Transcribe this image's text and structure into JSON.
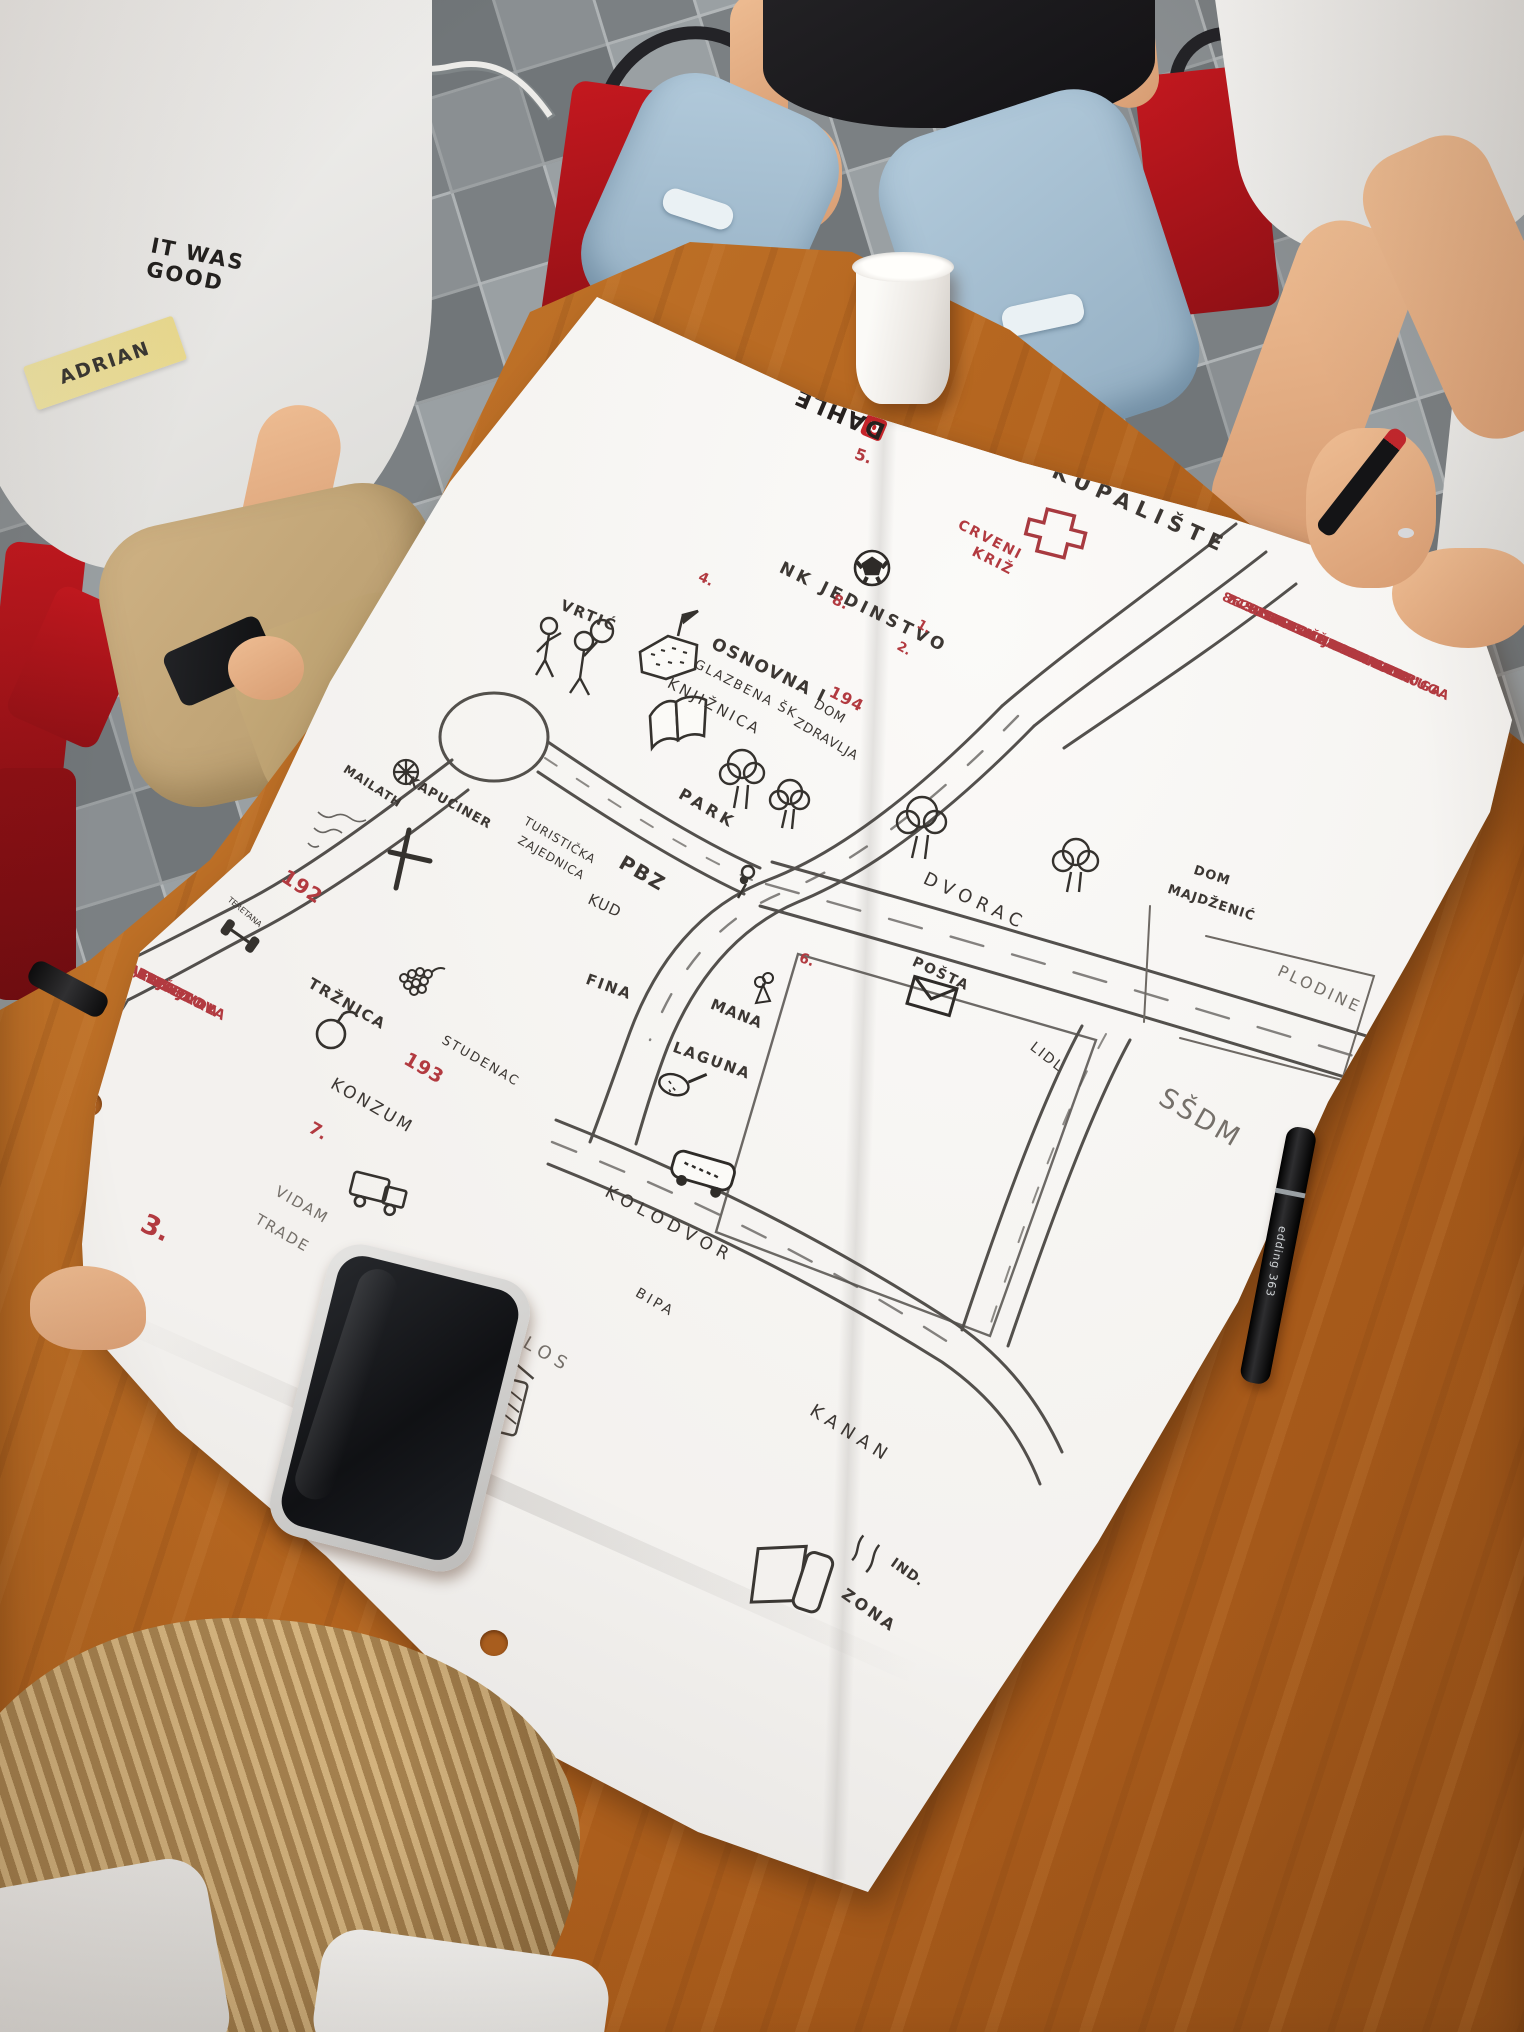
{
  "colors": {
    "paper": "#f3f1ee",
    "ink": "#3c3733",
    "red_marker": "#b23a40",
    "pencil": "#75706a",
    "table_wood": "#b4651f",
    "chair_red": "#b5161c",
    "floor_light": "#9aa0a3",
    "floor_dark": "#7b8083"
  },
  "people": {
    "left_person": {
      "shirt_print": "IT WAS\nGOOD",
      "name_tag": "ADRIAN"
    }
  },
  "paper": {
    "brand_logo": "DAHLE"
  },
  "items": {
    "marker_brand": "edding 363"
  },
  "map": {
    "title_area": "hand-drawn town map",
    "texts": [
      {
        "t": "KUPALIŠTE",
        "x": 1058,
        "y": 460,
        "r": 24,
        "s": 21,
        "ls": 7,
        "c": "ink",
        "w": 600
      },
      {
        "t": "CRVENI",
        "x": 962,
        "y": 518,
        "r": 27,
        "s": 14,
        "ls": 2,
        "c": "red",
        "w": 700
      },
      {
        "t": "KRIŽ",
        "x": 976,
        "y": 545,
        "r": 27,
        "s": 14,
        "ls": 2,
        "c": "red",
        "w": 700
      },
      {
        "t": "NK JEDINSTVO",
        "x": 784,
        "y": 560,
        "r": 26,
        "s": 17,
        "ls": 4,
        "c": "ink",
        "w": 600
      },
      {
        "t": "8.",
        "x": 836,
        "y": 592,
        "r": 25,
        "s": 15,
        "ls": 0,
        "c": "red",
        "w": 700
      },
      {
        "t": "4.",
        "x": 702,
        "y": 570,
        "r": 25,
        "s": 14,
        "ls": 0,
        "c": "red",
        "w": 700
      },
      {
        "t": "1.",
        "x": 921,
        "y": 618,
        "r": 30,
        "s": 13,
        "ls": 0,
        "c": "red",
        "w": 700
      },
      {
        "t": "2.",
        "x": 901,
        "y": 640,
        "r": 30,
        "s": 13,
        "ls": 0,
        "c": "red",
        "w": 700
      },
      {
        "t": "5.",
        "x": 858,
        "y": 446,
        "r": 20,
        "s": 16,
        "ls": 0,
        "c": "red",
        "w": 700
      },
      {
        "t": "VRTIĆ",
        "x": 564,
        "y": 598,
        "r": 22,
        "s": 15,
        "ls": 2,
        "c": "ink",
        "w": 600
      },
      {
        "t": "OSNOVNA I",
        "x": 716,
        "y": 636,
        "r": 26,
        "s": 17,
        "ls": 2,
        "c": "ink",
        "w": 600
      },
      {
        "t": "GLAZBENA ŠK",
        "x": 698,
        "y": 658,
        "r": 27,
        "s": 13,
        "ls": 2,
        "c": "ink",
        "w": 500
      },
      {
        "t": "194",
        "x": 834,
        "y": 684,
        "r": 27,
        "s": 16,
        "ls": 1,
        "c": "red",
        "w": 700
      },
      {
        "t": "KNJIŽNICA",
        "x": 672,
        "y": 676,
        "r": 28,
        "s": 15,
        "ls": 3,
        "c": "ink",
        "w": 500
      },
      {
        "t": "DOM",
        "x": 818,
        "y": 698,
        "r": 30,
        "s": 13,
        "ls": 1,
        "c": "ink",
        "w": 500
      },
      {
        "t": "ZDRAVLJA",
        "x": 798,
        "y": 716,
        "r": 30,
        "s": 13,
        "ls": 1,
        "c": "ink",
        "w": 500
      },
      {
        "t": "PARK",
        "x": 684,
        "y": 786,
        "r": 30,
        "s": 16,
        "ls": 4,
        "c": "ink",
        "w": 600
      },
      {
        "t": "MAILATH",
        "x": 348,
        "y": 763,
        "r": 33,
        "s": 12,
        "ls": 1,
        "c": "ink",
        "w": 600
      },
      {
        "t": "KAPUCINER",
        "x": 412,
        "y": 775,
        "r": 29,
        "s": 13,
        "ls": 1,
        "c": "ink",
        "w": 600
      },
      {
        "t": "192",
        "x": 289,
        "y": 866,
        "r": 33,
        "s": 20,
        "ls": 1,
        "c": "red",
        "w": 700
      },
      {
        "t": "TERETANA",
        "x": 231,
        "y": 896,
        "r": 40,
        "s": 8,
        "ls": 0,
        "c": "ink",
        "w": 500
      },
      {
        "t": "TURISTIČKA",
        "x": 528,
        "y": 815,
        "r": 30,
        "s": 12,
        "ls": 1,
        "c": "ink",
        "w": 500
      },
      {
        "t": "ZAJEDNICA",
        "x": 522,
        "y": 834,
        "r": 30,
        "s": 12,
        "ls": 1,
        "c": "ink",
        "w": 500
      },
      {
        "t": "PBZ",
        "x": 626,
        "y": 852,
        "r": 30,
        "s": 20,
        "ls": 2,
        "c": "ink",
        "w": 600
      },
      {
        "t": "KUD",
        "x": 592,
        "y": 892,
        "r": 25,
        "s": 15,
        "ls": 1,
        "c": "ink",
        "w": 500
      },
      {
        "t": "FINA",
        "x": 589,
        "y": 972,
        "r": 20,
        "s": 15,
        "ls": 2,
        "c": "ink",
        "w": 600
      },
      {
        "t": "MANA",
        "x": 714,
        "y": 997,
        "r": 22,
        "s": 15,
        "ls": 1,
        "c": "ink",
        "w": 600
      },
      {
        "t": "LAGUNA",
        "x": 676,
        "y": 1040,
        "r": 20,
        "s": 15,
        "ls": 2,
        "c": "ink",
        "w": 600
      },
      {
        "t": "DVORAC",
        "x": 928,
        "y": 870,
        "r": 25,
        "s": 18,
        "ls": 6,
        "c": "ink",
        "w": 500
      },
      {
        "t": "6.",
        "x": 802,
        "y": 951,
        "r": 20,
        "s": 14,
        "ls": 0,
        "c": "red",
        "w": 700
      },
      {
        "t": "POŠTA",
        "x": 916,
        "y": 955,
        "r": 25,
        "s": 14,
        "ls": 2,
        "c": "ink",
        "w": 700
      },
      {
        "t": "DOM",
        "x": 1196,
        "y": 864,
        "r": 18,
        "s": 13,
        "ls": 1,
        "c": "ink",
        "w": 600
      },
      {
        "t": "MAJDŽENIĆ",
        "x": 1170,
        "y": 883,
        "r": 18,
        "s": 13,
        "ls": 1,
        "c": "ink",
        "w": 600
      },
      {
        "t": "PLODINE",
        "x": 1282,
        "y": 963,
        "r": 25,
        "s": 16,
        "ls": 3,
        "c": "pencil",
        "w": 500
      },
      {
        "t": "LIDL",
        "x": 1036,
        "y": 1040,
        "r": 38,
        "s": 14,
        "ls": 2,
        "c": "ink",
        "w": 500
      },
      {
        "t": "SŠDM",
        "x": 1168,
        "y": 1084,
        "r": 30,
        "s": 27,
        "ls": 3,
        "c": "pencil",
        "w": 500
      },
      {
        "t": "TRŽNICA",
        "x": 313,
        "y": 976,
        "r": 30,
        "s": 15,
        "ls": 2,
        "c": "ink",
        "w": 600
      },
      {
        "t": "193",
        "x": 410,
        "y": 1050,
        "r": 30,
        "s": 19,
        "ls": 1,
        "c": "red",
        "w": 700
      },
      {
        "t": "STUDENAC",
        "x": 446,
        "y": 1034,
        "r": 30,
        "s": 13,
        "ls": 2,
        "c": "ink",
        "w": 500
      },
      {
        "t": "KONZUM",
        "x": 336,
        "y": 1076,
        "r": 30,
        "s": 17,
        "ls": 3,
        "c": "ink",
        "w": 500
      },
      {
        "t": "7.",
        "x": 314,
        "y": 1120,
        "r": 30,
        "s": 17,
        "ls": 0,
        "c": "red",
        "w": 700
      },
      {
        "t": "VIDAM",
        "x": 280,
        "y": 1184,
        "r": 30,
        "s": 15,
        "ls": 2,
        "c": "pencil",
        "w": 500
      },
      {
        "t": "TRADE",
        "x": 260,
        "y": 1212,
        "r": 30,
        "s": 15,
        "ls": 2,
        "c": "pencil",
        "w": 500
      },
      {
        "t": "3.",
        "x": 148,
        "y": 1210,
        "r": 25,
        "s": 27,
        "ls": 0,
        "c": "red",
        "w": 700
      },
      {
        "t": "KOLODVOR",
        "x": 610,
        "y": 1184,
        "r": 28,
        "s": 17,
        "ls": 6,
        "c": "ink",
        "w": 500
      },
      {
        "t": "BIPA",
        "x": 640,
        "y": 1286,
        "r": 30,
        "s": 14,
        "ls": 3,
        "c": "ink",
        "w": 500
      },
      {
        "t": "SILOS",
        "x": 504,
        "y": 1320,
        "r": 30,
        "s": 18,
        "ls": 6,
        "c": "pencil",
        "w": 500
      },
      {
        "t": "KANAN",
        "x": 816,
        "y": 1402,
        "r": 32,
        "s": 18,
        "ls": 6,
        "c": "ink",
        "w": 500
      },
      {
        "t": "IND.",
        "x": 896,
        "y": 1556,
        "r": 35,
        "s": 14,
        "ls": 1,
        "c": "ink",
        "w": 600
      },
      {
        "t": "ZONA",
        "x": 848,
        "y": 1586,
        "r": 35,
        "s": 16,
        "ls": 3,
        "c": "ink",
        "w": 600
      }
    ],
    "right_list": {
      "x": 1244,
      "y": 598,
      "r": 24,
      "fs": 13,
      "lh": 21,
      "lines": [
        {
          "t": "1. POVIJESNA UDRUGA",
          "ind": 26
        },
        {
          "t": "MAILATH",
          "ind": 112
        },
        {
          "t": "2. STRELIČARSKA UDRUGA",
          "ind": 0
        },
        {
          "t": "3. BOBY DM",
          "ind": 8
        },
        {
          "t": "4. KUGLAČKI KLUB",
          "ind": -6
        },
        {
          "t": "5. RIBOLOVNA UDRUGA",
          "ind": -14
        },
        {
          "t": "6. UDRUGA \"KUPUSARI\"",
          "ind": -10
        },
        {
          "t": "7. UDRUGA SPECTRUM",
          "ind": -16
        },
        {
          "t": "8. SPORTSKE UDRUGE",
          "ind": -20
        }
      ]
    },
    "left_list": {
      "x": 24,
      "y": 906,
      "r": 27,
      "fs": 14,
      "lh": 26,
      "lines": [
        {
          "t": "- ZIMKO",
          "ind": 118
        },
        {
          "t": "- SIJELO",
          "ind": 92
        },
        {
          "t": "- BORBA VITEZOVA",
          "ind": 58
        },
        {
          "t": "- PRANDAU FESTIVAL",
          "ind": 26
        },
        {
          "t": "- ČOBANIJADA, FIŠIJADA",
          "ind": 0
        },
        {
          "t": "- ADVENT",
          "ind": 40
        },
        {
          "t": "- DAN GRADA",
          "ind": 22
        },
        {
          "t": "- MIHOLJAČKI SAJAM",
          "ind": 2
        }
      ]
    }
  }
}
